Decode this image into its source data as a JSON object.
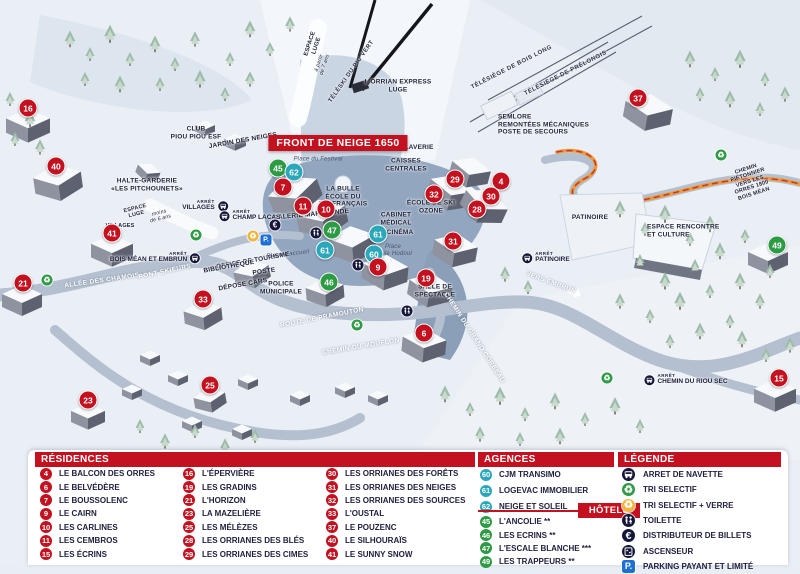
{
  "map": {
    "banner": {
      "text": "FRONT DE NEIGE 1650",
      "x": 338,
      "y": 143
    },
    "arret_caption": "ARRÊT",
    "markers": [
      {
        "n": "16",
        "type": "r",
        "x": 28,
        "y": 108
      },
      {
        "n": "40",
        "type": "r",
        "x": 56,
        "y": 166
      },
      {
        "n": "41",
        "type": "r",
        "x": 112,
        "y": 233
      },
      {
        "n": "21",
        "type": "r",
        "x": 23,
        "y": 283
      },
      {
        "n": "33",
        "type": "r",
        "x": 203,
        "y": 299
      },
      {
        "n": "23",
        "type": "r",
        "x": 88,
        "y": 400
      },
      {
        "n": "25",
        "type": "r",
        "x": 210,
        "y": 385
      },
      {
        "n": "45",
        "type": "h",
        "x": 278,
        "y": 168
      },
      {
        "n": "62",
        "type": "a",
        "x": 294,
        "y": 172
      },
      {
        "n": "7",
        "type": "r",
        "x": 283,
        "y": 187
      },
      {
        "n": "11",
        "type": "r",
        "x": 303,
        "y": 206
      },
      {
        "n": "10",
        "type": "r",
        "x": 326,
        "y": 209
      },
      {
        "n": "47",
        "type": "h",
        "x": 332,
        "y": 230
      },
      {
        "n": "61",
        "type": "a",
        "x": 325,
        "y": 250
      },
      {
        "n": "61",
        "type": "a",
        "x": 378,
        "y": 234
      },
      {
        "n": "60",
        "type": "a",
        "x": 374,
        "y": 254
      },
      {
        "n": "9",
        "type": "r",
        "x": 378,
        "y": 267
      },
      {
        "n": "46",
        "type": "h",
        "x": 329,
        "y": 282
      },
      {
        "n": "19",
        "type": "r",
        "x": 426,
        "y": 278
      },
      {
        "n": "6",
        "type": "r",
        "x": 424,
        "y": 333
      },
      {
        "n": "31",
        "type": "r",
        "x": 453,
        "y": 241
      },
      {
        "n": "32",
        "type": "r",
        "x": 434,
        "y": 194
      },
      {
        "n": "29",
        "type": "r",
        "x": 455,
        "y": 179
      },
      {
        "n": "4",
        "type": "r",
        "x": 501,
        "y": 181
      },
      {
        "n": "30",
        "type": "r",
        "x": 491,
        "y": 196
      },
      {
        "n": "28",
        "type": "r",
        "x": 477,
        "y": 209
      },
      {
        "n": "37",
        "type": "r",
        "x": 638,
        "y": 98
      },
      {
        "n": "49",
        "type": "h",
        "x": 777,
        "y": 245
      },
      {
        "n": "15",
        "type": "r",
        "x": 779,
        "y": 378
      }
    ],
    "labels": [
      {
        "text": "L'ORRIAN EXPRESS\nLUGE",
        "x": 398,
        "y": 86,
        "cls": "poi"
      },
      {
        "text": "TÉLÉSKI DU PIC VERT",
        "x": 352,
        "y": 72,
        "rot": -55,
        "cls": "lift"
      },
      {
        "text": "TÉLÉSIÈGE DE BOIS LONG",
        "x": 512,
        "y": 68,
        "rot": -27,
        "cls": "lift"
      },
      {
        "text": "TÉLÉSIÈGE DE PRÉLONGIS",
        "x": 566,
        "y": 74,
        "rot": -27,
        "cls": "lift"
      },
      {
        "text": "ESPACE\nLUGE",
        "x": 314,
        "y": 45,
        "rot": -72,
        "cls": "sign"
      },
      {
        "text": "à partir\nde 7 ans",
        "x": 322,
        "y": 64,
        "rot": -72,
        "cls": "tiny-italic"
      },
      {
        "text": "SEMLORE\nREMONTÉES MÉCANIQUES\nPOSTE DE SECOURS",
        "x": 498,
        "y": 125,
        "cls": "poi-left"
      },
      {
        "text": "CLUB\nPIOU PIOU ESF",
        "x": 196,
        "y": 133,
        "cls": "poi"
      },
      {
        "text": "JARDIN DES NEIGES",
        "x": 243,
        "y": 141,
        "rot": -10,
        "cls": "poi"
      },
      {
        "text": "HALTE-GARDERIE\n«LES PITCHOUNETS»",
        "x": 147,
        "y": 185,
        "cls": "poi"
      },
      {
        "text": "ESPACE\nLUGE",
        "x": 136,
        "y": 212,
        "rot": -14,
        "cls": "tiny"
      },
      {
        "text": "moins\nde 6 ans",
        "x": 160,
        "y": 216,
        "rot": -14,
        "cls": "tiny-italic"
      },
      {
        "text": "Place du Festival",
        "x": 318,
        "y": 160,
        "cls": "place"
      },
      {
        "text": "LA BULLE\nÉCOLE DU\nSKI FRANÇAIS",
        "x": 343,
        "y": 197,
        "cls": "poi"
      },
      {
        "text": "CAISSES\nCENTRALES",
        "x": 406,
        "y": 165,
        "cls": "poi"
      },
      {
        "text": "LAVERIE",
        "x": 419,
        "y": 148,
        "cls": "poi"
      },
      {
        "text": "GALERIE MARCHANDE",
        "x": 311,
        "y": 215,
        "rot": -5,
        "cls": "poi"
      },
      {
        "text": "CABINET\nMÉDICAL",
        "x": 396,
        "y": 219,
        "cls": "poi"
      },
      {
        "text": "CINÉMA",
        "x": 400,
        "y": 233,
        "cls": "poi"
      },
      {
        "text": "Place\nÉmile Hodoul",
        "x": 393,
        "y": 251,
        "cls": "place"
      },
      {
        "text": "ÉCOLE DE SKI\nOZONE",
        "x": 431,
        "y": 207,
        "cls": "poi"
      },
      {
        "text": "OFFICE DE TOURISME",
        "x": 253,
        "y": 261,
        "rot": -10,
        "cls": "poi"
      },
      {
        "text": "POSTE",
        "x": 264,
        "y": 272,
        "rot": -8,
        "cls": "poi"
      },
      {
        "text": "BIBLIOTHÈQUE",
        "x": 229,
        "y": 267,
        "rot": -10,
        "cls": "poi"
      },
      {
        "text": "DÉPOSE CARS",
        "x": 243,
        "y": 285,
        "rot": -10,
        "cls": "poi"
      },
      {
        "text": "POLICE\nMUNICIPALE",
        "x": 281,
        "y": 288,
        "cls": "poi"
      },
      {
        "text": "Place d'accueil",
        "x": 288,
        "y": 255,
        "rot": -6,
        "cls": "place"
      },
      {
        "text": "SALLE DE\nSPECTACLE",
        "x": 435,
        "y": 291,
        "cls": "poi"
      },
      {
        "text": "PATINOIRE",
        "x": 590,
        "y": 218,
        "cls": "poi"
      },
      {
        "text": "ESPACE RENCONTRE\nET CULTURE",
        "x": 647,
        "y": 231,
        "cls": "poi-left"
      },
      {
        "text": "VERS EMBRUN",
        "x": 551,
        "y": 283,
        "rot": 20,
        "cls": "road"
      },
      {
        "text": "ALLÉE DES CHAMOIS",
        "x": 102,
        "y": 281,
        "rot": -8,
        "cls": "road"
      },
      {
        "text": "PONT SKIEURS",
        "x": 165,
        "y": 272,
        "rot": -12,
        "cls": "road"
      },
      {
        "text": "ROUTE DE PRAMOUTON",
        "x": 322,
        "y": 318,
        "rot": -11,
        "cls": "road"
      },
      {
        "text": "CHEMIN DU MOUFLON",
        "x": 361,
        "y": 347,
        "rot": -9,
        "cls": "road"
      },
      {
        "text": "CHEMIN DU GRAND CORBEAU",
        "x": 474,
        "y": 338,
        "rot": 57,
        "cls": "road"
      },
      {
        "text": "CHEMIN PIÉTONNIER\nVERS LES ORRES 1800\nBOIS MÉAN",
        "x": 750,
        "y": 182,
        "rot": -18,
        "cls": "tiny"
      },
      {
        "text": "VILLAGES",
        "x": 120,
        "y": 226,
        "rot": 0,
        "cls": "tiny"
      }
    ],
    "bus_stops": [
      {
        "label": "VILLAGES",
        "x": 205,
        "y": 206,
        "side": "right"
      },
      {
        "label": "CHAMP LACAS",
        "x": 250,
        "y": 216,
        "side": "left"
      },
      {
        "label": "BOIS MÉAN ET EMBRUN",
        "x": 155,
        "y": 258,
        "side": "right"
      },
      {
        "label": "PATINOIRE",
        "x": 546,
        "y": 258,
        "side": "left"
      },
      {
        "label": "CHEMIN DU RIOU SEC",
        "x": 686,
        "y": 380,
        "side": "left"
      }
    ],
    "icons": [
      {
        "type": "recycle-green",
        "x": 196,
        "y": 235
      },
      {
        "type": "recycle-green",
        "x": 47,
        "y": 280
      },
      {
        "type": "recycle-green",
        "x": 357,
        "y": 325
      },
      {
        "type": "recycle-green",
        "x": 721,
        "y": 155
      },
      {
        "type": "recycle-green",
        "x": 607,
        "y": 378
      },
      {
        "type": "recycle-glass",
        "x": 253,
        "y": 236
      },
      {
        "type": "parking",
        "x": 266,
        "y": 240
      },
      {
        "type": "euro",
        "x": 275,
        "y": 225
      },
      {
        "type": "toilet",
        "x": 316,
        "y": 233
      },
      {
        "type": "toilet",
        "x": 358,
        "y": 265
      },
      {
        "type": "toilet",
        "x": 407,
        "y": 311
      }
    ]
  },
  "legend": {
    "residences": {
      "title": "RÉSIDENCES",
      "items": [
        {
          "n": "4",
          "label": "LE BALCON DES ORRES"
        },
        {
          "n": "6",
          "label": "LE BELVÉDÈRE"
        },
        {
          "n": "7",
          "label": "LE BOUSSOLENC"
        },
        {
          "n": "9",
          "label": "LE CAIRN"
        },
        {
          "n": "10",
          "label": "LES CARLINES"
        },
        {
          "n": "11",
          "label": "LES CEMBROS"
        },
        {
          "n": "15",
          "label": "LES ÉCRINS"
        },
        {
          "n": "16",
          "label": "L'ÉPERVIÈRE"
        },
        {
          "n": "19",
          "label": "LES GRADINS"
        },
        {
          "n": "21",
          "label": "L'HORIZON"
        },
        {
          "n": "23",
          "label": "LA MAZELIÈRE"
        },
        {
          "n": "25",
          "label": "LES MÉLÈZES"
        },
        {
          "n": "28",
          "label": "LES ORRIANES DES BLÉS"
        },
        {
          "n": "29",
          "label": "LES ORRIANES DES CIMES"
        },
        {
          "n": "30",
          "label": "LES ORRIANES DES FORÊTS"
        },
        {
          "n": "31",
          "label": "LES ORRIANES DES NEIGES"
        },
        {
          "n": "32",
          "label": "LES ORRIANES DES SOURCES"
        },
        {
          "n": "33",
          "label": "L'OUSTAL"
        },
        {
          "n": "37",
          "label": "LE POUZENC"
        },
        {
          "n": "40",
          "label": "LE SILHOURAÏS"
        },
        {
          "n": "41",
          "label": "LE SUNNY SNOW"
        }
      ]
    },
    "agencies": {
      "title": "AGENCES IMMOBILIÈRES",
      "items": [
        {
          "n": "60",
          "label": "CJM TRANSIMO"
        },
        {
          "n": "61",
          "label": "LOGEVAC IMMOBILIER"
        },
        {
          "n": "62",
          "label": "NEIGE ET SOLEIL"
        }
      ]
    },
    "hotels": {
      "title": "HÔTELS",
      "items": [
        {
          "n": "45",
          "label": "L'ANCOLIE **"
        },
        {
          "n": "46",
          "label": "LES ECRINS **"
        },
        {
          "n": "47",
          "label": "L'ESCALE BLANCHE ***"
        },
        {
          "n": "49",
          "label": "LES TRAPPEURS **"
        }
      ]
    },
    "legende": {
      "title": "LÉGENDE",
      "items": [
        {
          "icon": "bus",
          "label": "ARRET DE NAVETTE"
        },
        {
          "icon": "recycle-green",
          "label": "TRI SELECTIF"
        },
        {
          "icon": "recycle-glass",
          "label": "TRI SELECTIF + VERRE"
        },
        {
          "icon": "toilet",
          "label": "TOILETTE"
        },
        {
          "icon": "euro",
          "label": "DISTRIBUTEUR DE BILLETS"
        },
        {
          "icon": "elevator",
          "label": "ASCENSEUR"
        },
        {
          "icon": "parking",
          "label": "PARKING PAYANT ET LIMITÉ"
        }
      ]
    }
  },
  "colors": {
    "residence": "#c3111f",
    "hotel": "#2d9b43",
    "agency": "#2ba7bc",
    "header_red": "#c3111f",
    "parking_blue": "#1d6fd1",
    "glass_yellow": "#f0b53c",
    "legend_dark": "#15163a"
  }
}
